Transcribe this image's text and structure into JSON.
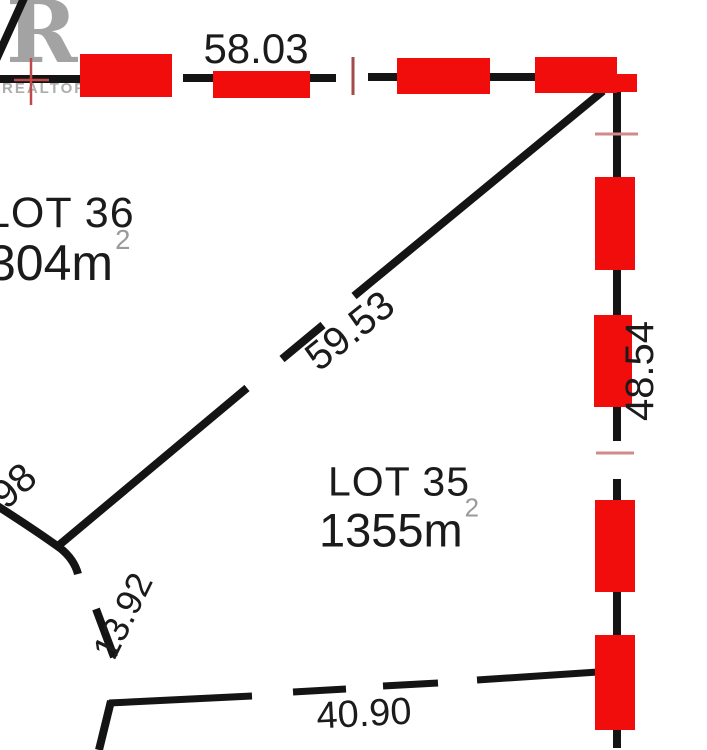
{
  "watermark": {
    "logo_letter": "R",
    "brand": "REALTOR",
    "reg_mark": "®"
  },
  "lots": [
    {
      "name": "LOT 36",
      "area": "304m",
      "area_sup": "2"
    },
    {
      "name": "LOT 35",
      "area": "1355m",
      "area_sup": "2"
    }
  ],
  "measurements": [
    {
      "id": "top-boundary",
      "value": "58.03"
    },
    {
      "id": "diagonal-boundary",
      "value": "59.53"
    },
    {
      "id": "right-boundary",
      "value": "48.54"
    },
    {
      "id": "left-arc-partial",
      "value": "98"
    },
    {
      "id": "curve-segment",
      "value": "13.92"
    },
    {
      "id": "bottom-boundary",
      "value": "40.90"
    }
  ],
  "colors": {
    "highlight_red": "#f20d0d",
    "line_black": "#141414",
    "tick_pink": "#d18a8a",
    "tick_maroon": "#a34a4a",
    "marker_red": "#c04848",
    "logo_gray": "#8f8f8f",
    "superscript_gray": "#9a9a9a",
    "label_black": "#1b1b1b"
  }
}
